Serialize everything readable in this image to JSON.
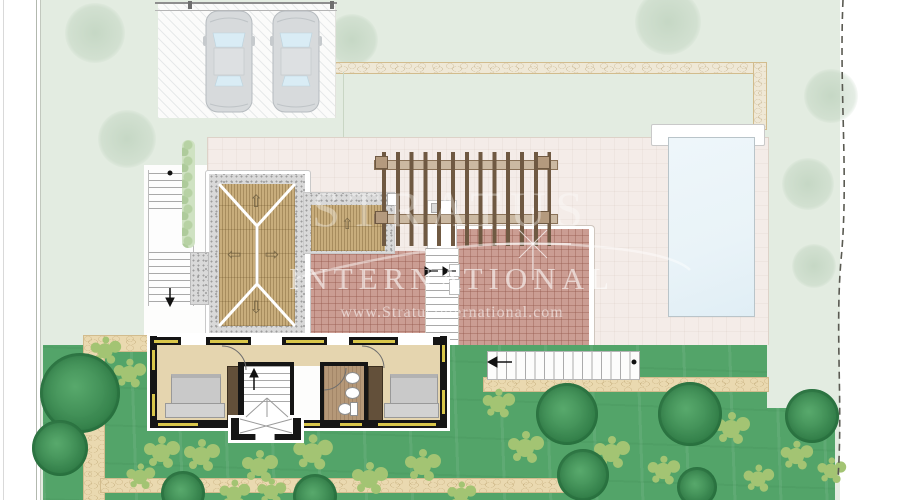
{
  "watermark": {
    "brand_top": "STRATUS",
    "brand_main": "INTERNATIONAL",
    "website": "www.StratusInternational.com"
  },
  "glyphs": {
    "arrow_up": "⇧",
    "arrow_down": "⇩",
    "arrow_left": "⇦",
    "arrow_right": "⇨"
  },
  "colors": {
    "page_bg": "#ffffff",
    "garden_pale": "#e3ece1",
    "lawn": "#53a469",
    "shrub": "#a3c473",
    "tree_dark": "#35854c",
    "path": "#ead9b0",
    "terrace": "#f4ece8",
    "terrace_low": "#f6f1ea",
    "tile_pink": "#cb9d93",
    "wood": "#c8ad7c",
    "concrete": "#d9d9d9",
    "pool": "#e9f3f8",
    "wall": "#151515",
    "window": "#d9c64a",
    "floor": "#e5d5af",
    "bath_floor": "#b59878",
    "wardrobe": "#63503a",
    "bed": "#c9c9c9",
    "pergola": "#6f5942",
    "car": "#d7dadc",
    "watermark": "#ffffff"
  }
}
